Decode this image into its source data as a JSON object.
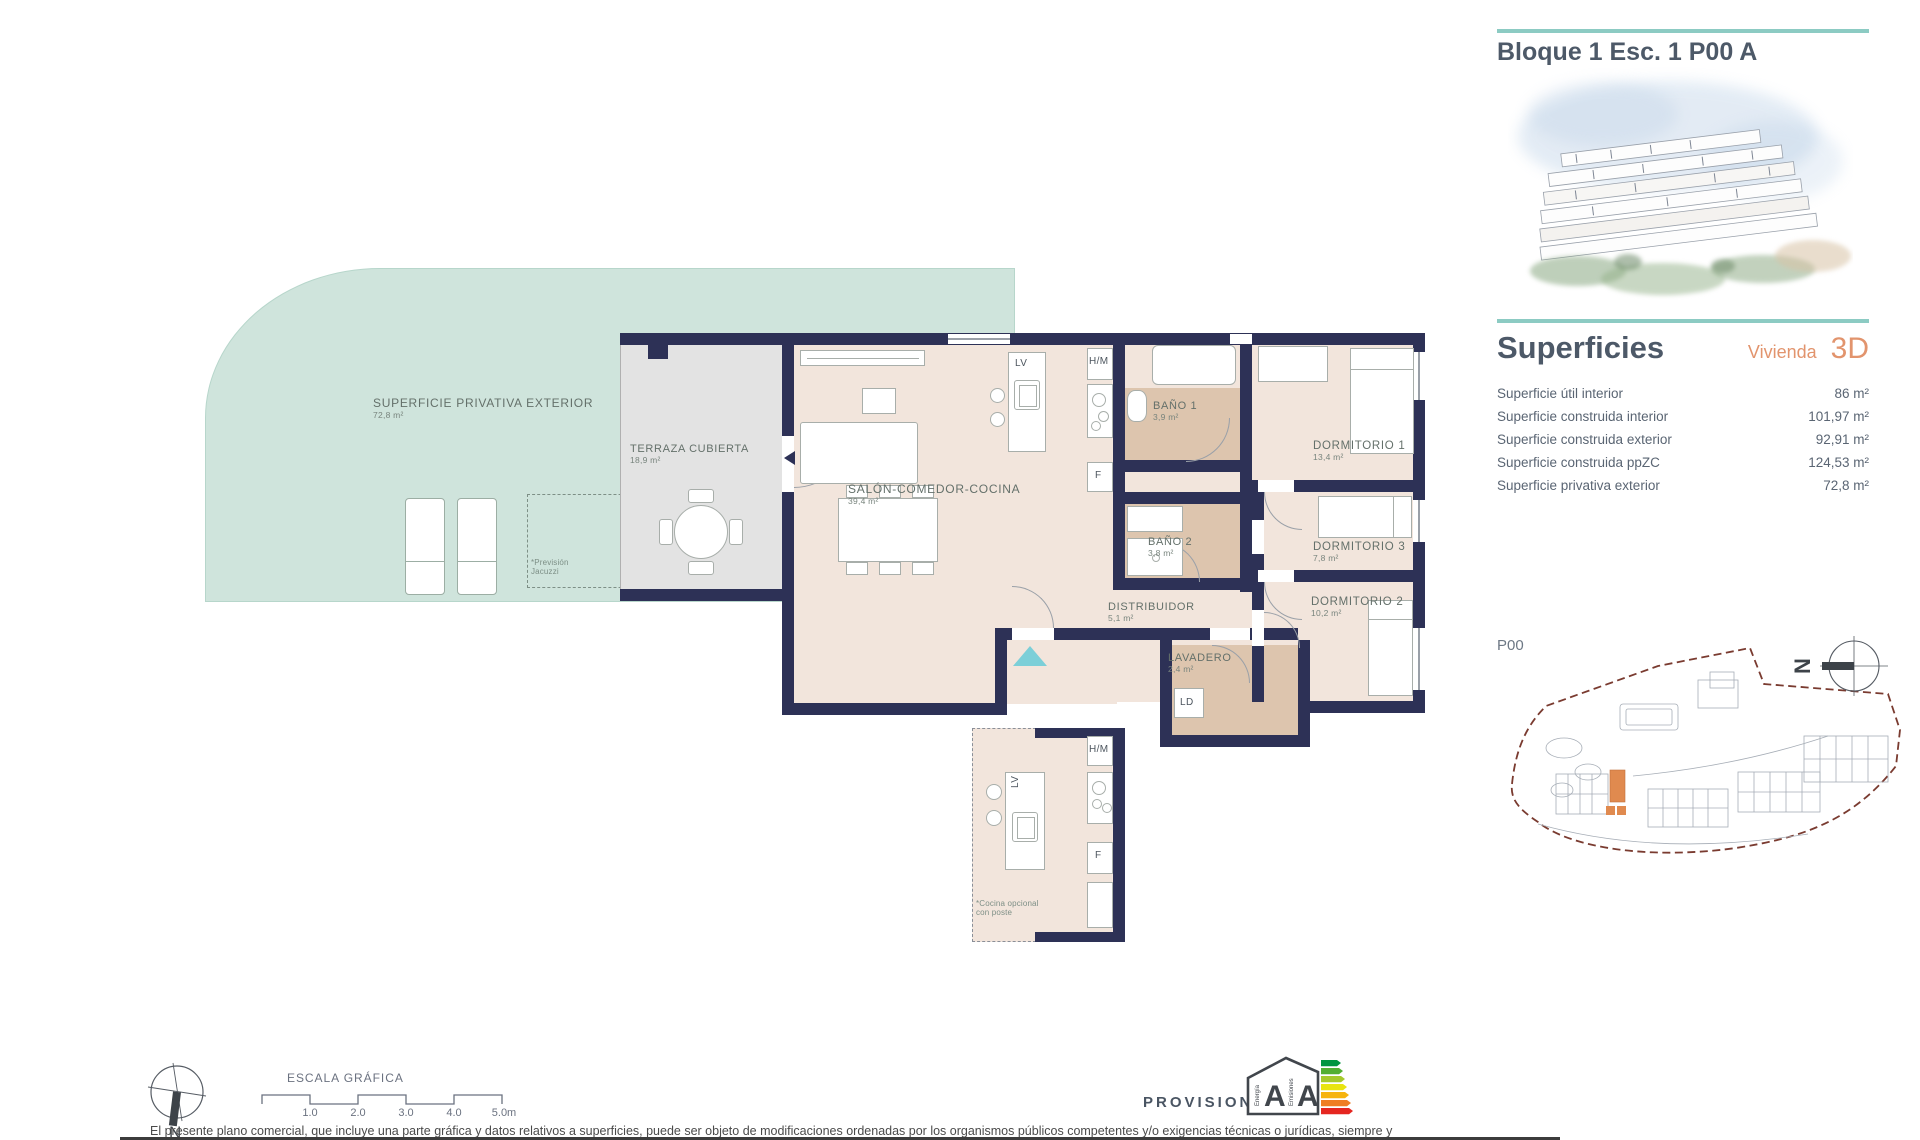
{
  "colors": {
    "accent_teal": "#8ccbc3",
    "accent_orange": "#e2946d",
    "wall_navy": "#2d3156",
    "exterior_teal": "#cfe4dc",
    "terrace_grey": "#e3e3e3",
    "floor_pink": "#f2e5dc",
    "bath_tan": "#ddc5ae",
    "entry_marker_cyan": "#7ccfd8",
    "site_boundary_red": "#7a3b30",
    "site_highlight_orange": "#e08a4f"
  },
  "header": {
    "title": "Bloque 1 Esc. 1 P00 A"
  },
  "superficies": {
    "heading": "Superficies",
    "dwelling_label": "Vivienda",
    "dwelling_code": "3D",
    "rows": [
      {
        "label": "Superficie útil interior",
        "value": "86 m²"
      },
      {
        "label": "Superficie construida interior",
        "value": "101,97 m²"
      },
      {
        "label": "Superficie construida exterior",
        "value": "92,91 m²"
      },
      {
        "label": "Superficie construida ppZC",
        "value": "124,53 m²"
      },
      {
        "label": "Superficie privativa exterior",
        "value": "72,8 m²"
      }
    ]
  },
  "site": {
    "floor_label": "P00",
    "north": "N"
  },
  "plan": {
    "rooms": {
      "exterior": {
        "label": "SUPERFICIE PRIVATIVA EXTERIOR",
        "area": "72,8 m²"
      },
      "covered_terrace": {
        "label": "TERRAZA CUBIERTA",
        "area": "18,9 m²"
      },
      "living": {
        "label": "SALÓN-COMEDOR-COCINA",
        "area": "39,4 m²"
      },
      "bath1": {
        "label": "BAÑO 1",
        "area": "3,9 m²"
      },
      "bath2": {
        "label": "BAÑO 2",
        "area": "3,8 m²"
      },
      "bedroom1": {
        "label": "DORMITORIO 1",
        "area": "13,4 m²"
      },
      "bedroom3": {
        "label": "DORMITORIO 3",
        "area": "7,8 m²"
      },
      "bedroom2": {
        "label": "DORMITORIO 2",
        "area": "10,2 m²"
      },
      "hall": {
        "label": "DISTRIBUIDOR",
        "area": "5,1 m²"
      },
      "laundry": {
        "label": "LAVADERO",
        "area": "2,4 m²"
      }
    },
    "appliances": {
      "dishwasher": "LV",
      "washer_dryer": "H/M",
      "fridge": "F",
      "dryer": "LD"
    },
    "jacuzzi_note": {
      "line1": "*Previsión",
      "line2": "Jacuzzi"
    },
    "optional_kitchen_note": {
      "line1": "*Cocina opcional",
      "line2": "con poste"
    }
  },
  "footer": {
    "north": "N",
    "scale_title": "ESCALA GRÁFICA",
    "scale_ticks": [
      "1.0",
      "2.0",
      "3.0",
      "4.0",
      "5.0m"
    ],
    "provisional": "PROVISIONAL",
    "energy": {
      "energy_letter": "A",
      "emissions_letter": "A",
      "energy_label": "Energía",
      "emissions_label": "Emisiones"
    },
    "disclaimer": "El presente plano comercial, que incluye una parte gráfica y datos relativos a superficies, puede ser objeto de modificaciones ordenadas por los organismos públicos competentes y/o exigencias técnicas o jurídicas, siempre y"
  }
}
